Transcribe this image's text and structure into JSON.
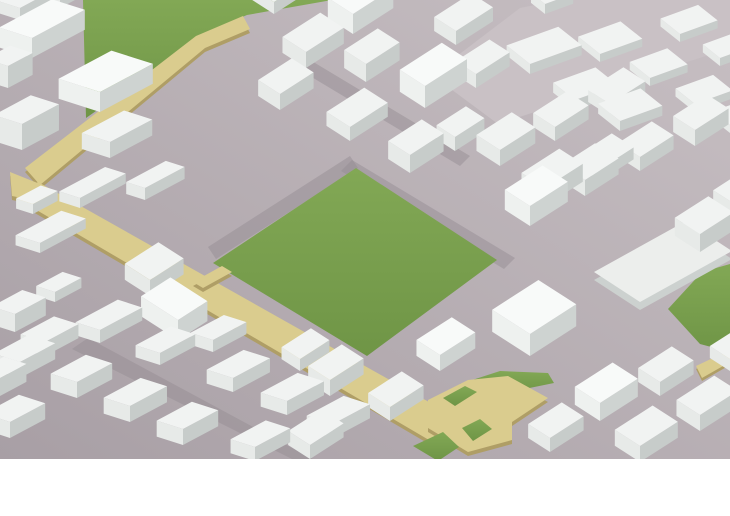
{
  "scene": {
    "name": "isometric-city-massing-model",
    "canvas": {
      "width": 730,
      "height": 516,
      "model_height": 459
    },
    "palette": {
      "background": "#ffffff",
      "ground_light": "#c7bfc3",
      "ground_dark": "#a89fa5",
      "road_plaza": "#c9c1c5",
      "street": "#968d94",
      "park_light": "#82a855",
      "park_dark": "#6f9546",
      "path_top": "#dacc8e",
      "path_side": "#af9e66",
      "platform_top": "#eceeec",
      "platform_side": "#ccd1cf"
    },
    "building_variants": [
      {
        "top": "#f1f3f2",
        "left": "#e7eae8",
        "right": "#c7ccca"
      },
      {
        "top": "#f8faf9",
        "left": "#eef1ef",
        "right": "#ced3d1"
      },
      {
        "top": "#e9ecea",
        "left": "#dfe3e1",
        "right": "#bfc4c2"
      }
    ],
    "grids": [
      {
        "name": "main-grid",
        "ur": [
          0.84,
          -0.54
        ],
        "ul": [
          -0.84,
          -0.54
        ]
      },
      {
        "name": "northeast-grid",
        "ur": [
          0.94,
          -0.34
        ],
        "ul": [
          -0.78,
          -0.62
        ]
      },
      {
        "name": "west-grid",
        "ur": [
          0.88,
          -0.47
        ],
        "ul": [
          -0.94,
          -0.3
        ]
      }
    ],
    "ground_polys": [
      {
        "name": "road-plaza-northeast",
        "fill": "#c9c1c5",
        "pts": [
          [
            432,
            75
          ],
          [
            520,
            8
          ],
          [
            560,
            0
          ],
          [
            730,
            0
          ],
          [
            730,
            48
          ],
          [
            498,
            124
          ]
        ]
      }
    ],
    "streets": [
      {
        "name": "street-park-northeast",
        "pts": [
          [
            352,
            160
          ],
          [
            515,
            258
          ],
          [
            504,
            269
          ],
          [
            341,
            171
          ]
        ]
      },
      {
        "name": "street-park-northwest",
        "pts": [
          [
            350,
            156
          ],
          [
            208,
            247
          ],
          [
            216,
            259
          ],
          [
            358,
            168
          ]
        ]
      },
      {
        "name": "street-southwest-district",
        "pts": [
          [
            88,
            338
          ],
          [
            320,
            463
          ],
          [
            300,
            463
          ],
          [
            72,
            349
          ]
        ]
      },
      {
        "name": "street-north-district",
        "pts": [
          [
            310,
            60
          ],
          [
            470,
            156
          ],
          [
            460,
            166
          ],
          [
            300,
            70
          ]
        ]
      }
    ],
    "parks": [
      {
        "name": "central-park",
        "pts": [
          [
            356,
            168
          ],
          [
            497,
            260
          ],
          [
            367,
            356
          ],
          [
            213,
            263
          ]
        ]
      },
      {
        "name": "northwest-park",
        "pts": [
          [
            83,
            0
          ],
          [
            86,
            118
          ],
          [
            140,
            80
          ],
          [
            198,
            36
          ],
          [
            247,
            15
          ],
          [
            332,
            0
          ]
        ]
      },
      {
        "name": "east-edge-park",
        "pts": [
          [
            668,
            309
          ],
          [
            702,
            272
          ],
          [
            730,
            264
          ],
          [
            730,
            352
          ],
          [
            700,
            344
          ]
        ]
      },
      {
        "name": "pocket-park-north-strip",
        "pts": [
          [
            460,
            384
          ],
          [
            500,
            371
          ],
          [
            548,
            373
          ],
          [
            554,
            383
          ],
          [
            500,
            394
          ]
        ]
      }
    ],
    "slabs": [
      {
        "name": "path-upper-segment",
        "h": 4,
        "top": "#dacc8e",
        "side": "#af9e66",
        "pts": [
          [
            25,
            168
          ],
          [
            196,
            36
          ],
          [
            243,
            16
          ],
          [
            250,
            29
          ],
          [
            205,
            48
          ],
          [
            40,
            185
          ]
        ]
      },
      {
        "name": "path-bend",
        "h": 4,
        "top": "#dacc8e",
        "side": "#af9e66",
        "pts": [
          [
            10,
            172
          ],
          [
            40,
            184
          ],
          [
            42,
            202
          ],
          [
            12,
            196
          ]
        ]
      },
      {
        "name": "path-main-segment",
        "h": 4,
        "top": "#dacc8e",
        "side": "#af9e66",
        "pts": [
          [
            38,
            182
          ],
          [
            468,
            424
          ],
          [
            446,
            450
          ],
          [
            16,
            198
          ]
        ]
      },
      {
        "name": "path-park-spur",
        "h": 4,
        "top": "#dacc8e",
        "side": "#af9e66",
        "pts": [
          [
            193,
            282
          ],
          [
            222,
            266
          ],
          [
            232,
            272
          ],
          [
            203,
            288
          ]
        ]
      },
      {
        "name": "path-junction-plaza",
        "h": 4,
        "top": "#dacc8e",
        "side": "#af9e66",
        "pts": [
          [
            428,
            400
          ],
          [
            468,
            380
          ],
          [
            508,
            376
          ],
          [
            548,
            398
          ],
          [
            512,
            422
          ],
          [
            512,
            440
          ],
          [
            468,
            452
          ],
          [
            428,
            428
          ]
        ]
      },
      {
        "name": "path-east-edge-bit",
        "h": 3,
        "top": "#dacc8e",
        "side": "#af9e66",
        "pts": [
          [
            696,
            366
          ],
          [
            730,
            350
          ],
          [
            730,
            362
          ],
          [
            702,
            378
          ]
        ]
      },
      {
        "name": "east-platform",
        "h": 8,
        "top": "#eceeec",
        "side": "#ccd1cf",
        "pts": [
          [
            640,
            302
          ],
          [
            732,
            251
          ],
          [
            686,
            221
          ],
          [
            594,
            272
          ]
        ]
      }
    ],
    "parks_over": [
      {
        "name": "pocket-park-west",
        "pts": [
          [
            443,
            398
          ],
          [
            465,
            386
          ],
          [
            477,
            392
          ],
          [
            455,
            406
          ]
        ]
      },
      {
        "name": "pocket-park-notch",
        "pts": [
          [
            462,
            428
          ],
          [
            480,
            419
          ],
          [
            492,
            429
          ],
          [
            473,
            441
          ]
        ]
      },
      {
        "name": "pocket-park-south",
        "pts": [
          [
            413,
            446
          ],
          [
            443,
            432
          ],
          [
            459,
            447
          ],
          [
            438,
            461
          ]
        ]
      }
    ],
    "building_format": [
      "corner_x",
      "corner_y",
      "width",
      "depth",
      "height",
      "grid",
      "variant"
    ],
    "buildings": [
      [
        20,
        20,
        35,
        25,
        12,
        2,
        0
      ],
      [
        60,
        8,
        22,
        16,
        8,
        2,
        0
      ],
      [
        32,
        58,
        60,
        35,
        20,
        2,
        1
      ],
      [
        8,
        88,
        28,
        24,
        22,
        2,
        0
      ],
      [
        100,
        112,
        60,
        44,
        20,
        2,
        1
      ],
      [
        22,
        150,
        42,
        30,
        26,
        2,
        0
      ],
      [
        110,
        158,
        48,
        30,
        16,
        2,
        0
      ],
      [
        145,
        200,
        45,
        20,
        12,
        2,
        0
      ],
      [
        80,
        208,
        52,
        22,
        10,
        2,
        0
      ],
      [
        33,
        214,
        28,
        18,
        10,
        2,
        0
      ],
      [
        40,
        253,
        52,
        26,
        10,
        2,
        0
      ],
      [
        55,
        302,
        30,
        20,
        10,
        2,
        0
      ],
      [
        15,
        332,
        35,
        25,
        18,
        2,
        0
      ],
      [
        274,
        14,
        40,
        26,
        12,
        0,
        0
      ],
      [
        353,
        34,
        48,
        30,
        20,
        0,
        1
      ],
      [
        306,
        68,
        45,
        28,
        16,
        0,
        0
      ],
      [
        366,
        82,
        40,
        26,
        18,
        0,
        0
      ],
      [
        456,
        45,
        44,
        26,
        14,
        0,
        0
      ],
      [
        476,
        88,
        40,
        24,
        14,
        0,
        0
      ],
      [
        425,
        108,
        50,
        30,
        22,
        0,
        1
      ],
      [
        280,
        110,
        40,
        26,
        16,
        0,
        0
      ],
      [
        350,
        141,
        45,
        28,
        14,
        0,
        0
      ],
      [
        455,
        151,
        35,
        22,
        14,
        0,
        0
      ],
      [
        410,
        173,
        40,
        26,
        18,
        0,
        0
      ],
      [
        545,
        14,
        30,
        18,
        10,
        1,
        0
      ],
      [
        530,
        74,
        55,
        30,
        10,
        1,
        0
      ],
      [
        600,
        62,
        45,
        28,
        8,
        1,
        0
      ],
      [
        680,
        42,
        40,
        25,
        8,
        1,
        0
      ],
      [
        720,
        66,
        35,
        22,
        8,
        1,
        0
      ],
      [
        650,
        86,
        40,
        26,
        8,
        1,
        0
      ],
      [
        575,
        110,
        45,
        28,
        10,
        1,
        0
      ],
      [
        695,
        112,
        40,
        25,
        8,
        1,
        0
      ],
      [
        620,
        131,
        45,
        28,
        10,
        1,
        0
      ],
      [
        730,
        133,
        35,
        22,
        8,
        1,
        0
      ],
      [
        500,
        166,
        42,
        28,
        16,
        0,
        0
      ],
      [
        555,
        141,
        40,
        26,
        14,
        0,
        0
      ],
      [
        610,
        116,
        42,
        26,
        12,
        0,
        0
      ],
      [
        640,
        171,
        40,
        26,
        14,
        0,
        0
      ],
      [
        600,
        181,
        40,
        26,
        12,
        0,
        0
      ],
      [
        695,
        146,
        40,
        26,
        16,
        0,
        0
      ],
      [
        545,
        206,
        45,
        28,
        18,
        0,
        0
      ],
      [
        585,
        196,
        40,
        28,
        16,
        0,
        0
      ],
      [
        530,
        226,
        45,
        30,
        20,
        0,
        1
      ],
      [
        730,
        211,
        30,
        20,
        10,
        0,
        0
      ],
      [
        700,
        252,
        40,
        30,
        18,
        0,
        0
      ],
      [
        530,
        356,
        55,
        45,
        22,
        0,
        1
      ],
      [
        150,
        296,
        40,
        30,
        16,
        0,
        0
      ],
      [
        100,
        343,
        48,
        26,
        13,
        2,
        0
      ],
      [
        178,
        340,
        35,
        44,
        20,
        0,
        1
      ],
      [
        45,
        356,
        38,
        26,
        14,
        2,
        0
      ],
      [
        20,
        378,
        40,
        28,
        16,
        2,
        0
      ],
      [
        0,
        396,
        30,
        24,
        18,
        2,
        0
      ],
      [
        77,
        398,
        40,
        28,
        16,
        2,
        0
      ],
      [
        130,
        422,
        42,
        28,
        16,
        2,
        0
      ],
      [
        10,
        438,
        40,
        28,
        16,
        2,
        0
      ],
      [
        183,
        445,
        40,
        28,
        16,
        2,
        0
      ],
      [
        160,
        365,
        40,
        26,
        12,
        2,
        0
      ],
      [
        213,
        352,
        38,
        24,
        12,
        2,
        0
      ],
      [
        233,
        392,
        42,
        28,
        14,
        2,
        0
      ],
      [
        287,
        415,
        42,
        28,
        14,
        2,
        0
      ],
      [
        333,
        438,
        42,
        28,
        14,
        2,
        0
      ],
      [
        255,
        461,
        40,
        26,
        14,
        2,
        0
      ],
      [
        300,
        371,
        35,
        22,
        12,
        0,
        0
      ],
      [
        330,
        396,
        40,
        26,
        16,
        0,
        0
      ],
      [
        390,
        421,
        40,
        26,
        14,
        0,
        0
      ],
      [
        310,
        459,
        40,
        26,
        14,
        0,
        0
      ],
      [
        440,
        371,
        42,
        28,
        16,
        0,
        1
      ],
      [
        600,
        421,
        45,
        30,
        18,
        0,
        1
      ],
      [
        660,
        396,
        40,
        26,
        14,
        0,
        0
      ],
      [
        730,
        371,
        35,
        24,
        12,
        0,
        0
      ],
      [
        700,
        431,
        45,
        28,
        16,
        0,
        0
      ],
      [
        550,
        452,
        40,
        26,
        14,
        0,
        0
      ],
      [
        640,
        462,
        45,
        30,
        16,
        0,
        0
      ]
    ]
  }
}
